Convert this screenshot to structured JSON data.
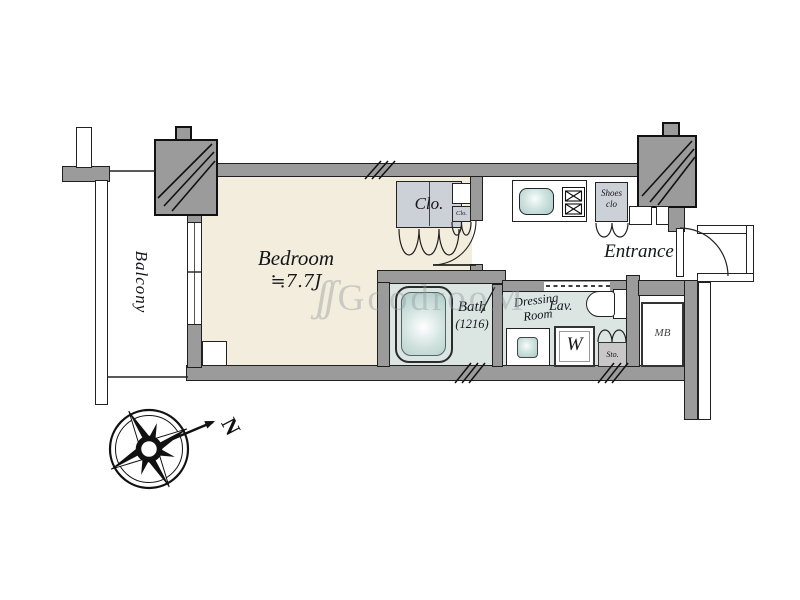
{
  "floorplan": {
    "watermark": {
      "glyph": "ʃʃ",
      "text": "GoodrooM"
    },
    "compass": {
      "north": "N"
    },
    "rooms": {
      "balcony": {
        "label": "Balcony"
      },
      "bedroom": {
        "label": "Bedroom",
        "size": "≒7.7J"
      },
      "closet": {
        "label": "Clo."
      },
      "closet_small": {
        "label": "Clo."
      },
      "bath": {
        "label": "Bath",
        "size": "(1216)"
      },
      "dressing_room": {
        "line1": "Dressing",
        "line2": "Room"
      },
      "lavatory": {
        "label": "Lav."
      },
      "washer": {
        "label": "W"
      },
      "storage": {
        "label": "Sto."
      },
      "shoes_closet": {
        "line1": "Shoes",
        "line2": "clo"
      },
      "entrance": {
        "label": "Entrance"
      },
      "meter_box": {
        "label": "MB"
      }
    },
    "colors": {
      "wall_fill": "#9b9b9b",
      "outline": "#1f1f1f",
      "bedroom_floor": "#f2eddd",
      "wet_area_floor": "#dbe5e1",
      "closet_fill": "#ccd1d8",
      "fixture_teal": "#aecfca"
    }
  }
}
